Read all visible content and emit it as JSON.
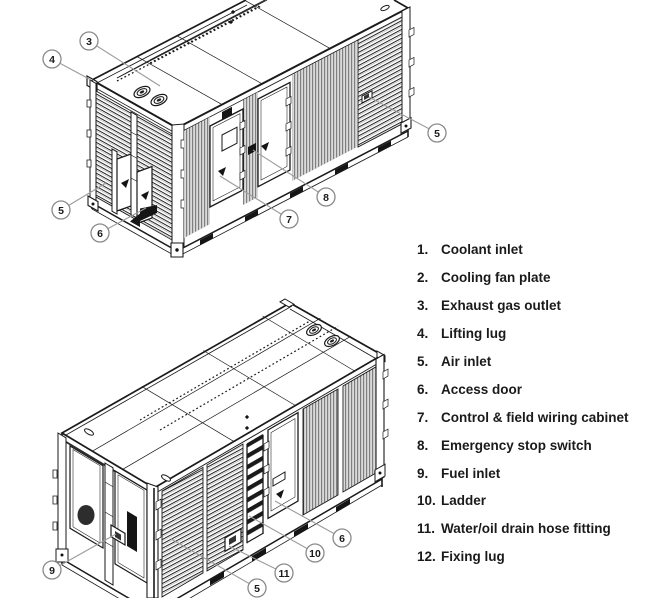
{
  "legend": {
    "items": [
      {
        "num": "1.",
        "label": "Coolant inlet"
      },
      {
        "num": "2.",
        "label": "Cooling fan plate"
      },
      {
        "num": "3.",
        "label": "Exhaust gas outlet"
      },
      {
        "num": "4.",
        "label": "Lifting lug"
      },
      {
        "num": "5.",
        "label": "Air inlet"
      },
      {
        "num": "6.",
        "label": "Access door"
      },
      {
        "num": "7.",
        "label": "Control & field wiring cabinet"
      },
      {
        "num": "8.",
        "label": "Emergency stop switch"
      },
      {
        "num": "9.",
        "label": "Fuel inlet"
      },
      {
        "num": "10.",
        "label": "Ladder"
      },
      {
        "num": "11.",
        "label": "Water/oil drain hose fitting"
      },
      {
        "num": "12.",
        "label": "Fixing lug"
      }
    ]
  },
  "callouts": {
    "top": [
      "3",
      "4",
      "5",
      "6",
      "7",
      "8",
      "5"
    ],
    "bottom": [
      "9",
      "5",
      "11",
      "10",
      "6"
    ]
  },
  "colors": {
    "line": "#1a1a1a",
    "leader": "#9c9c9c",
    "balloon_stroke": "#8a8a8a",
    "balloon_fill": "#ffffff"
  }
}
